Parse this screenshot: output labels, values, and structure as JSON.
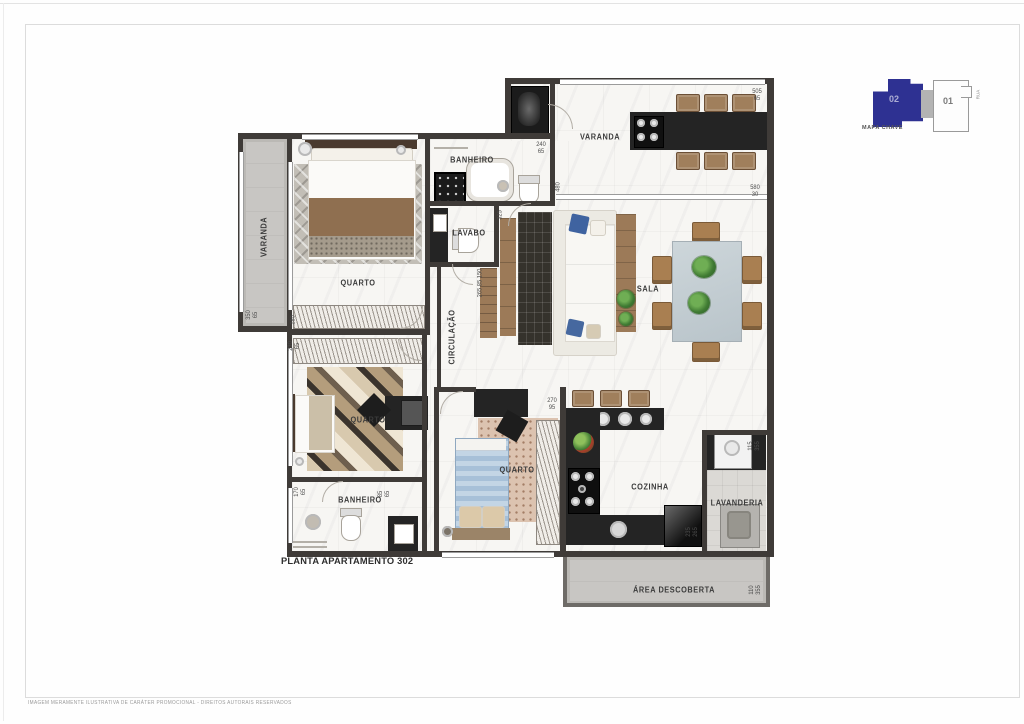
{
  "page": {
    "title_label": "PLANTA APARTAMENTO 302",
    "disclaimer": "IMAGEM MERAMENTE ILUSTRATIVA DE CARÁTER PROMOCIONAL - DIREITOS AUTORAIS RESERVADOS"
  },
  "key_map": {
    "label": "MAPA CHAVE",
    "street": "RUA",
    "highlight_color": "#2e3192",
    "units": [
      {
        "id": "02",
        "highlighted": true
      },
      {
        "id": "01",
        "highlighted": false
      }
    ]
  },
  "plan": {
    "rooms": [
      {
        "label": "VARANDA",
        "x": 264,
        "y": 237,
        "vertical": true
      },
      {
        "label": "QUARTO",
        "x": 358,
        "y": 283,
        "vertical": false
      },
      {
        "label": "BANHEIRO",
        "x": 472,
        "y": 160,
        "vertical": false
      },
      {
        "label": "LAVABO",
        "x": 469,
        "y": 233,
        "vertical": false
      },
      {
        "label": "VARANDA",
        "x": 600,
        "y": 137,
        "vertical": false
      },
      {
        "label": "SALA",
        "x": 648,
        "y": 289,
        "vertical": false
      },
      {
        "label": "CIRCULAÇÃO",
        "x": 452,
        "y": 337,
        "vertical": true
      },
      {
        "label": "QUARTO",
        "x": 368,
        "y": 420,
        "vertical": false
      },
      {
        "label": "QUARTO",
        "x": 517,
        "y": 470,
        "vertical": false
      },
      {
        "label": "BANHEIRO",
        "x": 360,
        "y": 500,
        "vertical": false
      },
      {
        "label": "COZINHA",
        "x": 650,
        "y": 487,
        "vertical": false
      },
      {
        "label": "LAVANDERIA",
        "x": 737,
        "y": 503,
        "vertical": false
      },
      {
        "label": "ÁREA DESCOBERTA",
        "x": 674,
        "y": 590,
        "vertical": false
      }
    ],
    "dimensions": [
      {
        "lines": [
          "505",
          "65"
        ],
        "x": 757,
        "y": 95,
        "vertical": false
      },
      {
        "lines": [
          "580",
          "30"
        ],
        "x": 755,
        "y": 191,
        "vertical": false
      },
      {
        "lines": [
          "240",
          "65"
        ],
        "x": 541,
        "y": 148,
        "vertical": false
      },
      {
        "lines": [
          "480"
        ],
        "x": 558,
        "y": 187,
        "vertical": true
      },
      {
        "lines": [
          "350",
          "65"
        ],
        "x": 252,
        "y": 315,
        "vertical": true
      },
      {
        "lines": [
          "280"
        ],
        "x": 293,
        "y": 320,
        "vertical": true
      },
      {
        "lines": [
          "230",
          "65"
        ],
        "x": 294,
        "y": 346,
        "vertical": true
      },
      {
        "lines": [
          "325"
        ],
        "x": 500,
        "y": 215,
        "vertical": true
      },
      {
        "lines": [
          "265 85 150"
        ],
        "x": 480,
        "y": 283,
        "vertical": true
      },
      {
        "lines": [
          "170",
          "65"
        ],
        "x": 300,
        "y": 492,
        "vertical": true
      },
      {
        "lines": [
          "85",
          "65"
        ],
        "x": 384,
        "y": 494,
        "vertical": true
      },
      {
        "lines": [
          "270",
          "95"
        ],
        "x": 552,
        "y": 404,
        "vertical": false
      },
      {
        "lines": [
          "115",
          "355"
        ],
        "x": 754,
        "y": 446,
        "vertical": true
      },
      {
        "lines": [
          "235",
          "265"
        ],
        "x": 692,
        "y": 532,
        "vertical": true
      },
      {
        "lines": [
          "110",
          "355"
        ],
        "x": 755,
        "y": 590,
        "vertical": true
      }
    ]
  },
  "colors": {
    "wall": "#3f3b38",
    "keymap_highlight": "#2e3192",
    "counter_dark": "#242424",
    "wood": "#9c7a58",
    "bed_blue": "#a7c0d8"
  }
}
